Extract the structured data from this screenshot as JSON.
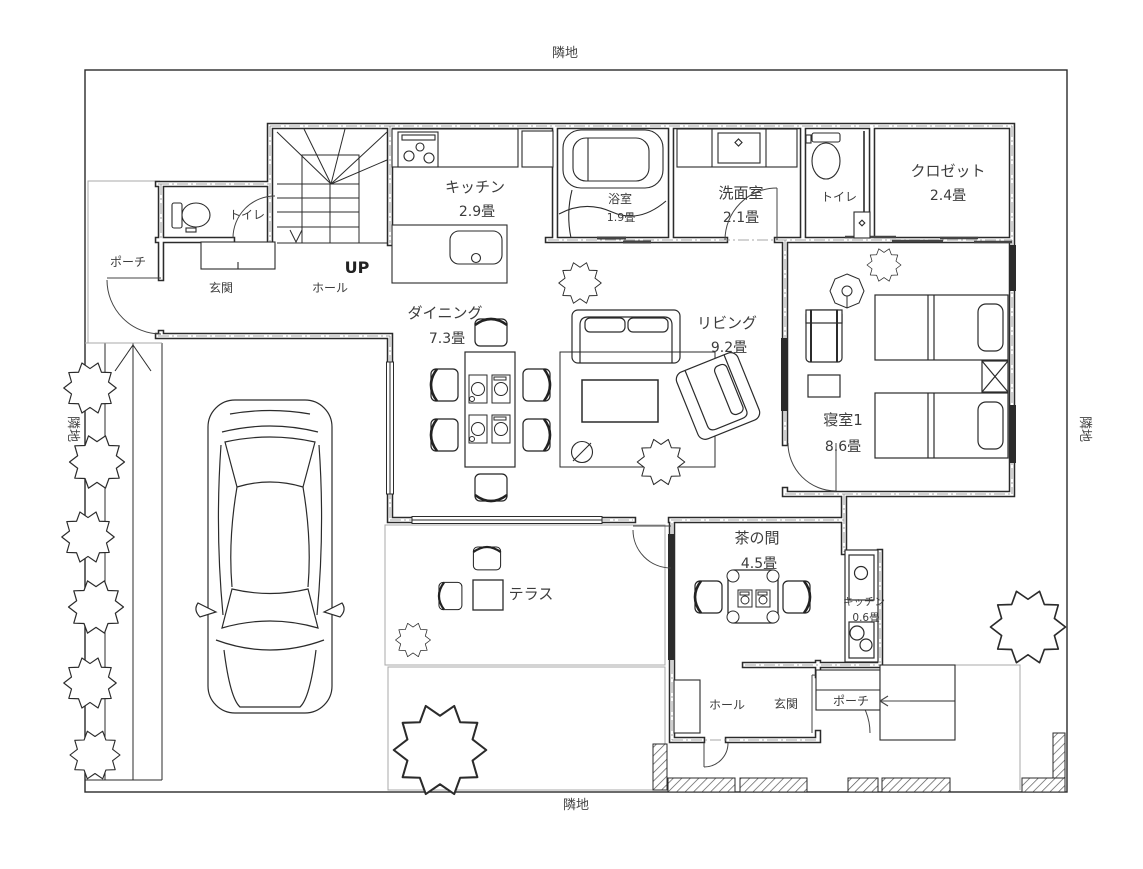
{
  "title": "住宅1階 間取り図",
  "site": {
    "adjacent_top": "隣地",
    "adjacent_bottom": "隣地",
    "adjacent_left": "隣地",
    "adjacent_right": "隣地"
  },
  "rooms": [
    {
      "id": "kitchen",
      "label": "キッチン",
      "area": "2.9畳"
    },
    {
      "id": "bathroom",
      "label": "浴室",
      "area": "1.9畳"
    },
    {
      "id": "washroom",
      "label": "洗面室",
      "area": "2.1畳"
    },
    {
      "id": "toilet-front",
      "label": "トイレ",
      "area": ""
    },
    {
      "id": "toilet-rear",
      "label": "トイレ",
      "area": ""
    },
    {
      "id": "closet",
      "label": "クロゼット",
      "area": "2.4畳"
    },
    {
      "id": "dining",
      "label": "ダイニング",
      "area": "7.3畳"
    },
    {
      "id": "living",
      "label": "リビング",
      "area": "9.2畳"
    },
    {
      "id": "bedroom-1",
      "label": "寝室1",
      "area": "8.6畳"
    },
    {
      "id": "tea-room",
      "label": "茶の間",
      "area": "4.5畳"
    },
    {
      "id": "kitchenette",
      "label": "キッチン",
      "area": "0.6畳"
    },
    {
      "id": "terrace",
      "label": "テラス",
      "area": ""
    }
  ],
  "annotations": {
    "stairs_up": "UP",
    "porch_front": "ポーチ",
    "entrance_front": "玄関",
    "hall_front": "ホール",
    "hall_rear": "ホール",
    "entrance_rear": "玄関",
    "porch_rear": "ポーチ"
  },
  "colors": {
    "line": "#2b2b2b",
    "light_line": "#9a9a9a",
    "text": "#3c3c3c",
    "background": "#ffffff"
  }
}
